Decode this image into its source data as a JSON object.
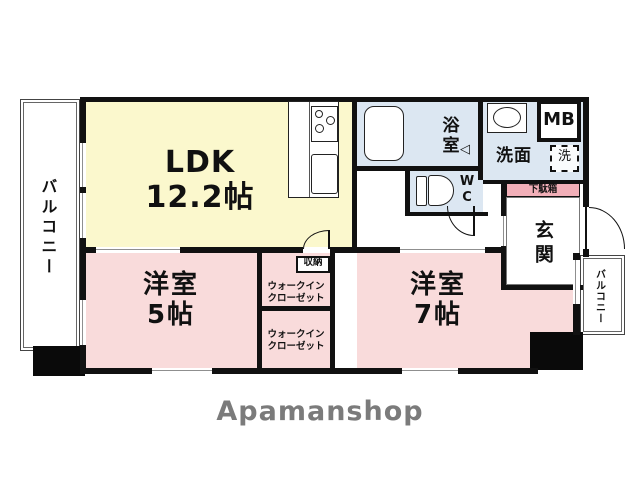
{
  "brand": {
    "logo_text": "Apamanshop"
  },
  "floorplan": {
    "ldk": {
      "label": "LDK",
      "size": "12.2帖"
    },
    "western_room_5": {
      "label": "洋室",
      "size": "5帖"
    },
    "western_room_7": {
      "label": "洋室",
      "size": "7帖"
    },
    "bath": {
      "label": "浴室"
    },
    "washroom": {
      "label": "洗面"
    },
    "wc": {
      "line1": "W",
      "line2": "C"
    },
    "meter_box": {
      "label": "MB"
    },
    "washing_machine": {
      "label": "洗"
    },
    "entrance": {
      "label": "玄関"
    },
    "shoe_cabinet": {
      "label": "下駄箱"
    },
    "storage": {
      "label": "収納"
    },
    "walk_in_closet_upper": {
      "line1": "ウォークイン",
      "line2": "クローゼット"
    },
    "walk_in_closet_lower": {
      "line1": "ウォークイン",
      "line2": "クローゼット"
    },
    "balcony_left": {
      "label": "バルコニー"
    },
    "balcony_right": {
      "label": "バルコニー"
    },
    "bath_door_marker": {
      "glyph": "◁"
    }
  },
  "colors": {
    "ldk_fill": "#FBF8CD",
    "room_fill": "#F9DBDB",
    "wet_area_fill": "#DCE7F2",
    "shoe_cabinet_fill": "#F2AFB8",
    "wall": "#111111",
    "logo_text_color": "#7B7B7B"
  }
}
